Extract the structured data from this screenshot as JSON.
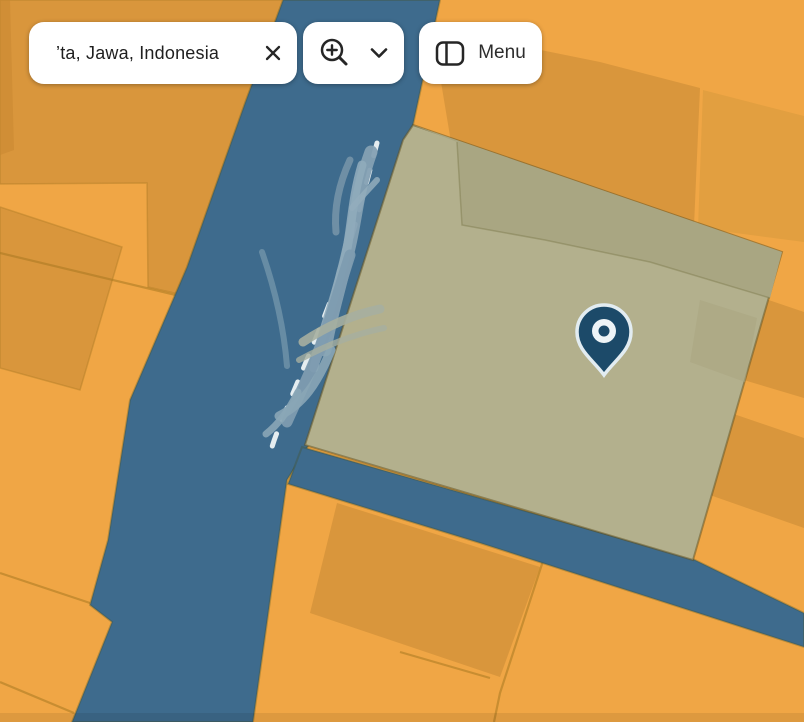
{
  "search": {
    "value": "’ta, Jawa, Indonesia",
    "clear_icon": "close-x"
  },
  "zoom_control": {
    "zoom_icon": "magnifier-plus",
    "expand_icon": "chevron-down"
  },
  "menu": {
    "label": "Menu",
    "icon": "sidebar-panel"
  },
  "map": {
    "marker": {
      "icon": "location-pin",
      "color": "#1c4a69"
    },
    "road_markings": "white dashed centerline",
    "annotations": "hand-drawn blue scribbles over road",
    "colors": {
      "parcel_orange": "#f0a645",
      "building_orange": "#d9963c",
      "road_blue": "#3e6b8d",
      "selected_parcel_khaki": "#b3b08d",
      "selected_parcel_shade": "#a9a682",
      "annotation_blue": "#8aa6b6",
      "pin_navy": "#1c4a69",
      "card_white": "#ffffff"
    }
  }
}
